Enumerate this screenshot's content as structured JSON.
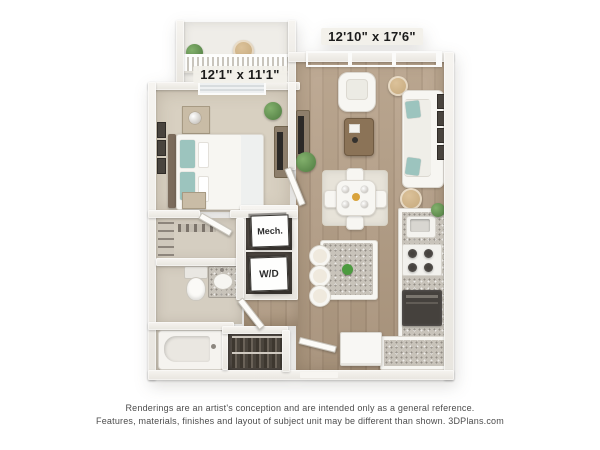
{
  "plan": {
    "living_dimensions": "12'10\" x 17'6\"",
    "bedroom_dimensions": "12'1\" x 11'1\"",
    "mech_closet": "Mech.",
    "washer_dryer": "W/D"
  },
  "disclaimer": {
    "line1": "Renderings are an artist's conception and are intended only as a general reference.",
    "line2": "Features, materials, finishes and layout of subject unit may be different than shown. 3DPlans.com"
  },
  "colors": {
    "carpet": "#d8d0c1",
    "tile": "#d5cec1",
    "wood": "#b29c83",
    "rug": "#e7e3d9",
    "white_furniture": "#f7f6f2",
    "teal": "#9cc4be",
    "tan_wood": "#c9bca6",
    "rattan": "#c2a578",
    "plant": "#4e7a40",
    "granite": "#c8c3ba",
    "appliance_dark": "#45413d",
    "closet_dark": "#58514a",
    "door": "#fcfbf8",
    "card_bg": "#fefefd",
    "label_ink": "#1c1c1c",
    "footer_ink": "#4d4d4d"
  }
}
